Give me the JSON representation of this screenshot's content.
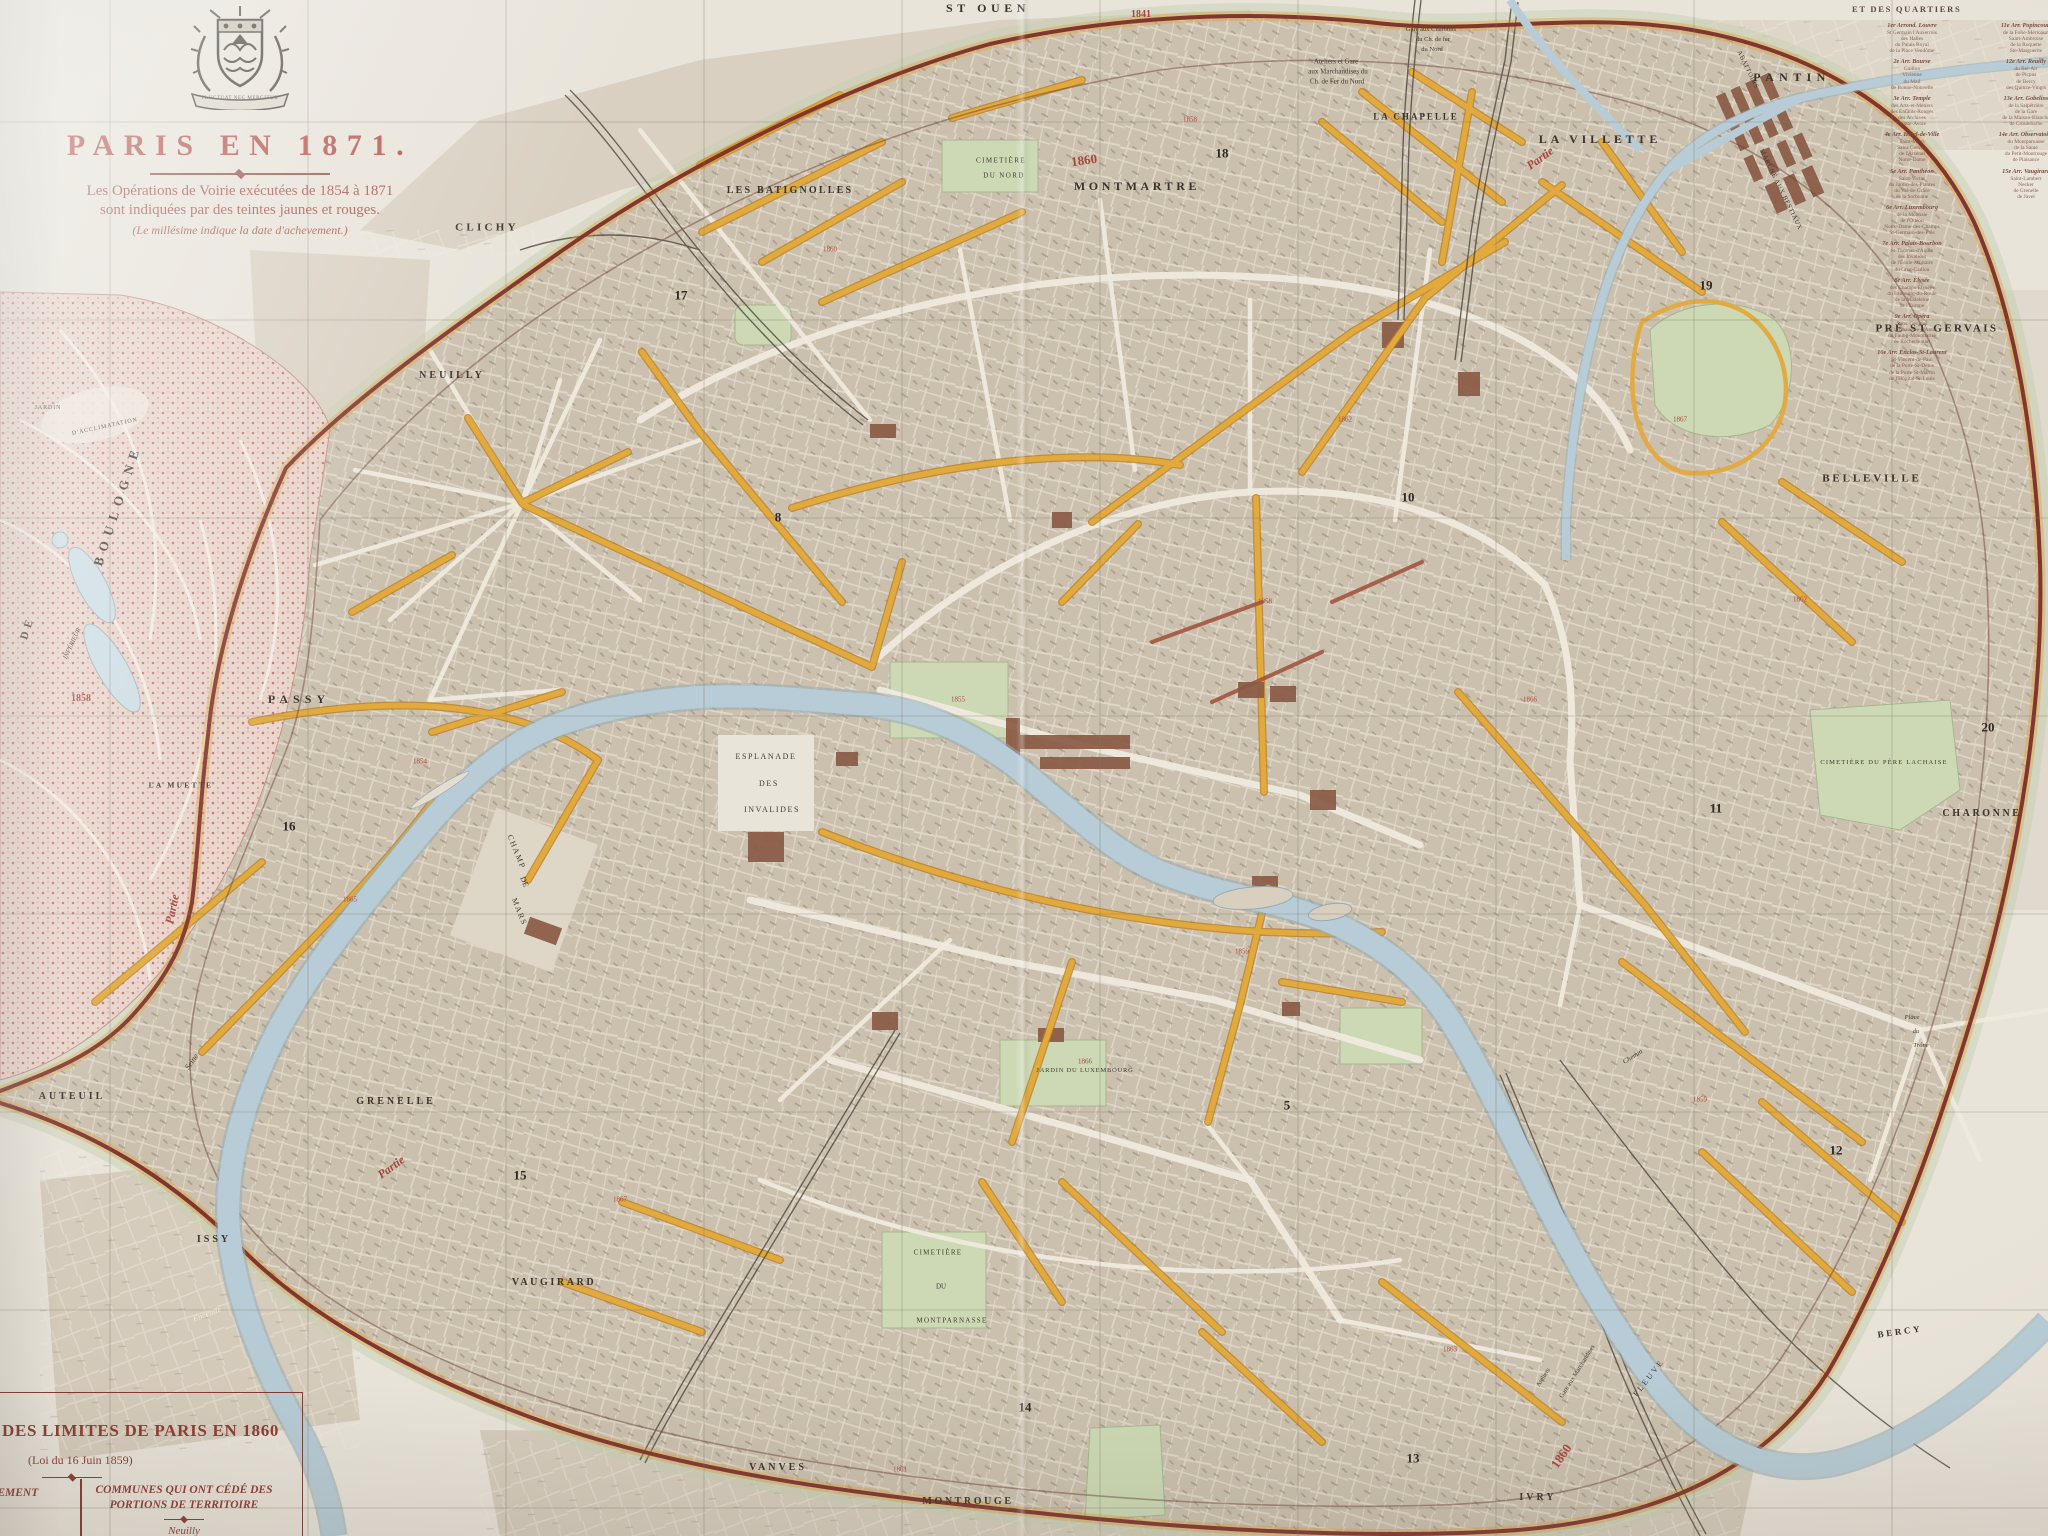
{
  "colors": {
    "paper": "#e9e4da",
    "city": "#cbc0ae",
    "suburb": "#d8cfc0",
    "water": "#b7ccd6",
    "park": "#ccd9b4",
    "bois_dot": "#ad5348",
    "wall_red": "#7c2f28",
    "ops_yellow": "#e2a93c",
    "title_red": "#b5544a",
    "legend_brown": "#7c4a3e",
    "text_black": "#38322a"
  },
  "title": {
    "main": "PARIS EN 1871.",
    "sub1": "Les Opérations de Voirie exécutées de 1854 à 1871",
    "sub2": "sont indiquées par des teintes jaunes et rouges.",
    "sub3": "(Le millésime indique la date d'achevement.)",
    "motto": "FLUCTUAT NEC MERGITUR"
  },
  "legend_quartiers": {
    "header": "ET DES QUARTIERS",
    "col1": [
      {
        "h": "1er Arrond. Louvre",
        "items": [
          "St Germain l'Auxerrois",
          "des Halles",
          "du Palais Royal",
          "de la Place Vendôme"
        ]
      },
      {
        "h": "2e Arr. Bourse",
        "items": [
          "Gaillon",
          "Vivienne",
          "du Mail",
          "de Bonne-Nouvelle"
        ]
      },
      {
        "h": "3e Arr. Temple",
        "items": [
          "des Arts-et-Métiers",
          "des Enfants-Rouges",
          "des Archives",
          "Sainte-Avoie"
        ]
      },
      {
        "h": "4e Arr. Hôtel-de-Ville",
        "items": [
          "Saint-Merri",
          "Saint-Gervais",
          "de l'Arsenal",
          "Notre-Dame"
        ]
      },
      {
        "h": "5e Arr. Panthéon",
        "items": [
          "Saint-Victor",
          "du Jardin-des-Plantes",
          "du Val-de-Grâce",
          "de la Sorbonne"
        ]
      },
      {
        "h": "6e Arr. Luxembourg",
        "items": [
          "de la Monnaie",
          "de l'Odéon",
          "Notre-Dame-des-Champs",
          "St-Germain-des-Prés"
        ]
      },
      {
        "h": "7e Arr. Palais-Bourbon",
        "items": [
          "St-Thomas-d'Aquin",
          "des Invalides",
          "de l'École-Militaire",
          "du Gros-Caillou"
        ]
      },
      {
        "h": "8e Arr. Élysée",
        "items": [
          "des Champs-Élysées",
          "du Faubourg-du-Roule",
          "de la Madeleine",
          "de l'Europe"
        ]
      },
      {
        "h": "9e Arr. Opéra",
        "items": [
          "Saint-Georges",
          "de la Chaussée-d'Antin",
          "du Faubg-Montmartre",
          "de Rochechouart"
        ]
      },
      {
        "h": "10e Arr. Enclos-St-Laurent",
        "items": [
          "St-Vincent-de-Paul",
          "de la Porte-St-Denis",
          "de la Porte-St-Martin",
          "de l'Hôpital-St-Louis"
        ]
      }
    ],
    "col2": [
      {
        "h": "11e Arr. Popincourt",
        "items": [
          "de la Folie-Méricourt",
          "Saint-Ambroise",
          "de la Roquette",
          "Ste-Marguerite"
        ]
      },
      {
        "h": "12e Arr. Reuilly",
        "items": [
          "du Bel-Air",
          "de Picpus",
          "de Bercy",
          "des Quinze-Vingts"
        ]
      },
      {
        "h": "13e Arr. Gobelins",
        "items": [
          "de la Salpêtrière",
          "de la Gare",
          "de la Maison-Blanche",
          "de Croulebarbe"
        ]
      },
      {
        "h": "14e Arr. Observatoire",
        "items": [
          "du Montparnasse",
          "de la Santé",
          "du Petit-Montrouge",
          "de Plaisance"
        ]
      },
      {
        "h": "15e Arr. Vaugirard",
        "items": [
          "Saint-Lambert",
          "Necker",
          "de Grenelle",
          "de Javel"
        ]
      }
    ]
  },
  "legend_limits": {
    "title": "DES LIMITES DE PARIS EN 1860",
    "law": "(Loi du 16 Juin 1859)",
    "col1_line1": "ÈREMENT",
    "col1_line2": "S",
    "col2_line1": "COMMUNES QUI ONT CÉDÉ DES",
    "col2_line2": "PORTIONS DE TERRITOIRE",
    "commune": "Neuilly"
  },
  "map_labels": [
    {
      "t": "ST OUEN",
      "x": 988,
      "y": 8,
      "s": 12,
      "k": "place",
      "ls": 0.38
    },
    {
      "t": "CLICHY",
      "x": 487,
      "y": 228,
      "s": 11,
      "k": "place",
      "ls": 0.3
    },
    {
      "t": "LES BATIGNOLLES",
      "x": 790,
      "y": 191,
      "s": 10,
      "k": "place",
      "ls": 0.22
    },
    {
      "t": "MONTMARTRE",
      "x": 1137,
      "y": 186,
      "s": 12,
      "k": "place",
      "ls": 0.3
    },
    {
      "t": "LA CHAPELLE",
      "x": 1416,
      "y": 117,
      "s": 9,
      "k": "place",
      "ls": 0.22
    },
    {
      "t": "LA VILLETTE",
      "x": 1600,
      "y": 139,
      "s": 12,
      "k": "place",
      "ls": 0.32
    },
    {
      "t": "PANTIN",
      "x": 1792,
      "y": 77,
      "s": 12,
      "k": "place",
      "ls": 0.45
    },
    {
      "t": "PRÉ ST GERVAIS",
      "x": 1937,
      "y": 329,
      "s": 11,
      "k": "place",
      "ls": 0.22
    },
    {
      "t": "BELLEVILLE",
      "x": 1872,
      "y": 479,
      "s": 11,
      "k": "place",
      "ls": 0.26
    },
    {
      "t": "CHARONNE",
      "x": 1982,
      "y": 814,
      "s": 10,
      "k": "place",
      "ls": 0.26
    },
    {
      "t": "NEUILLY",
      "x": 452,
      "y": 376,
      "s": 10,
      "k": "place",
      "ls": 0.3
    },
    {
      "t": "PASSY",
      "x": 299,
      "y": 699,
      "s": 12,
      "k": "place",
      "ls": 0.42
    },
    {
      "t": "LA MUETTE",
      "x": 181,
      "y": 785,
      "s": 7.5,
      "k": "place",
      "ls": 0.3
    },
    {
      "t": "AUTEUIL",
      "x": 72,
      "y": 1097,
      "s": 10,
      "k": "place",
      "ls": 0.3
    },
    {
      "t": "GRENELLE",
      "x": 396,
      "y": 1102,
      "s": 10,
      "k": "place",
      "ls": 0.3
    },
    {
      "t": "ISSY",
      "x": 214,
      "y": 1240,
      "s": 10,
      "k": "place",
      "ls": 0.3
    },
    {
      "t": "VAUGIRARD",
      "x": 554,
      "y": 1283,
      "s": 10,
      "k": "place",
      "ls": 0.26
    },
    {
      "t": "VANVES",
      "x": 778,
      "y": 1468,
      "s": 10,
      "k": "place",
      "ls": 0.3
    },
    {
      "t": "MONTROUGE",
      "x": 968,
      "y": 1502,
      "s": 10,
      "k": "place",
      "ls": 0.26
    },
    {
      "t": "IVRY",
      "x": 1538,
      "y": 1498,
      "s": 10,
      "k": "place",
      "ls": 0.3
    },
    {
      "t": "BERCY",
      "x": 1900,
      "y": 1332,
      "s": 9,
      "k": "place",
      "r": -8,
      "ls": 0.3
    },
    {
      "t": "BOULOGNE",
      "x": 117,
      "y": 505,
      "s": 13,
      "k": "place",
      "r": -72,
      "ls": 0.5
    },
    {
      "t": "DE",
      "x": 28,
      "y": 628,
      "s": 11,
      "k": "place",
      "r": -72,
      "ls": 0.4
    },
    {
      "t": "JARDIN",
      "x": 48,
      "y": 408,
      "s": 6,
      "k": "tiny",
      "ls": 0.15
    },
    {
      "t": "D'ACCLIMATATION",
      "x": 105,
      "y": 427,
      "s": 6,
      "k": "tiny",
      "r": -12,
      "ls": 0.15
    },
    {
      "t": "INFÉRIEUR",
      "x": 73,
      "y": 644,
      "s": 6.5,
      "k": "tiny-it",
      "r": -65
    },
    {
      "t": "17",
      "x": 681,
      "y": 295,
      "s": 13,
      "k": "num"
    },
    {
      "t": "18",
      "x": 1222,
      "y": 153,
      "s": 13,
      "k": "num"
    },
    {
      "t": "19",
      "x": 1706,
      "y": 285,
      "s": 13,
      "k": "num"
    },
    {
      "t": "10",
      "x": 1408,
      "y": 497,
      "s": 13,
      "k": "num"
    },
    {
      "t": "8",
      "x": 778,
      "y": 517,
      "s": 13,
      "k": "num"
    },
    {
      "t": "16",
      "x": 289,
      "y": 826,
      "s": 13,
      "k": "num"
    },
    {
      "t": "11",
      "x": 1716,
      "y": 808,
      "s": 13,
      "k": "num"
    },
    {
      "t": "20",
      "x": 1988,
      "y": 727,
      "s": 13,
      "k": "num"
    },
    {
      "t": "15",
      "x": 520,
      "y": 1175,
      "s": 13,
      "k": "num"
    },
    {
      "t": "5",
      "x": 1287,
      "y": 1105,
      "s": 13,
      "k": "num"
    },
    {
      "t": "12",
      "x": 1836,
      "y": 1150,
      "s": 13,
      "k": "num"
    },
    {
      "t": "14",
      "x": 1025,
      "y": 1407,
      "s": 13,
      "k": "num"
    },
    {
      "t": "13",
      "x": 1413,
      "y": 1458,
      "s": 13,
      "k": "num"
    },
    {
      "t": "CIMETIÈRE",
      "x": 1001,
      "y": 161,
      "s": 7,
      "k": "tiny",
      "ls": 0.2
    },
    {
      "t": "DU NORD",
      "x": 1004,
      "y": 176,
      "s": 7,
      "k": "tiny",
      "ls": 0.2
    },
    {
      "t": "CIMETIÈRE DU PÈRE LACHAISE",
      "x": 1884,
      "y": 763,
      "s": 6.5,
      "k": "tiny",
      "ls": 0.18
    },
    {
      "t": "CIMETIÈRE",
      "x": 938,
      "y": 1253,
      "s": 7,
      "k": "tiny",
      "ls": 0.18
    },
    {
      "t": "DU",
      "x": 941,
      "y": 1287,
      "s": 7,
      "k": "tiny"
    },
    {
      "t": "MONTPARNASSE",
      "x": 952,
      "y": 1321,
      "s": 7,
      "k": "tiny",
      "ls": 0.18
    },
    {
      "t": "ESPLANADE",
      "x": 766,
      "y": 757,
      "s": 8,
      "k": "tiny",
      "ls": 0.2
    },
    {
      "t": "DES",
      "x": 769,
      "y": 784,
      "s": 8,
      "k": "tiny",
      "ls": 0.2
    },
    {
      "t": "INVALIDES",
      "x": 772,
      "y": 810,
      "s": 8,
      "k": "tiny",
      "ls": 0.2
    },
    {
      "t": "CHAMP",
      "x": 516,
      "y": 852,
      "s": 8,
      "k": "tiny",
      "r": 68,
      "ls": 0.2
    },
    {
      "t": "DE",
      "x": 524,
      "y": 882,
      "s": 8,
      "k": "tiny",
      "r": 68
    },
    {
      "t": "MARS",
      "x": 519,
      "y": 912,
      "s": 8,
      "k": "tiny",
      "r": 68,
      "ls": 0.2
    },
    {
      "t": "JARDIN DU LUXEMBOURG",
      "x": 1085,
      "y": 1071,
      "s": 6.5,
      "k": "tiny",
      "ls": 0.12
    },
    {
      "t": "MARCHÉ AUX BESTIAUX",
      "x": 1780,
      "y": 190,
      "s": 6.5,
      "k": "tiny",
      "r": 64,
      "ls": 0.1
    },
    {
      "t": "ABATTOIRS",
      "x": 1747,
      "y": 70,
      "s": 6.5,
      "k": "tiny",
      "r": 64,
      "ls": 0.1
    },
    {
      "t": "Ateliers et Gare",
      "x": 1336,
      "y": 62,
      "s": 7,
      "k": "tiny"
    },
    {
      "t": "aux Marchandises du",
      "x": 1338,
      "y": 72,
      "s": 7,
      "k": "tiny"
    },
    {
      "t": "Ch. de Fer du Nord",
      "x": 1337,
      "y": 82,
      "s": 7,
      "k": "tiny"
    },
    {
      "t": "Gare aux Charbons",
      "x": 1431,
      "y": 30,
      "s": 6.5,
      "k": "tiny"
    },
    {
      "t": "du Ch. de fer",
      "x": 1433,
      "y": 40,
      "s": 6.5,
      "k": "tiny"
    },
    {
      "t": "du Nord",
      "x": 1432,
      "y": 50,
      "s": 6.5,
      "k": "tiny"
    },
    {
      "t": "Gare aux Marchandises",
      "x": 1578,
      "y": 1372,
      "s": 6.5,
      "k": "tiny",
      "r": -58
    },
    {
      "t": "Ateliers",
      "x": 1544,
      "y": 1378,
      "s": 6.5,
      "k": "tiny",
      "r": -58
    },
    {
      "t": "Place",
      "x": 1912,
      "y": 1018,
      "s": 6.5,
      "k": "tiny-it"
    },
    {
      "t": "du",
      "x": 1916,
      "y": 1032,
      "s": 6.5,
      "k": "tiny-it"
    },
    {
      "t": "Trône",
      "x": 1921,
      "y": 1046,
      "s": 6.5,
      "k": "tiny-it"
    },
    {
      "t": "Chemin",
      "x": 1633,
      "y": 1057,
      "s": 7,
      "k": "tiny-it",
      "r": -32
    },
    {
      "t": "Seine",
      "x": 192,
      "y": 1062,
      "s": 8,
      "k": "tiny-it",
      "r": -55
    },
    {
      "t": "FLEUVE",
      "x": 1649,
      "y": 1378,
      "s": 8,
      "k": "tiny",
      "r": -52,
      "ls": 0.3
    },
    {
      "t": "Partie",
      "x": 1540,
      "y": 158,
      "s": 12,
      "k": "red-it",
      "r": -36
    },
    {
      "t": "Partie",
      "x": 172,
      "y": 909,
      "s": 12,
      "k": "red-it",
      "r": -78
    },
    {
      "t": "Partie",
      "x": 391,
      "y": 1167,
      "s": 12,
      "k": "red-it",
      "r": -36
    },
    {
      "t": "1860",
      "x": 1084,
      "y": 160,
      "s": 13,
      "k": "red",
      "r": -8
    },
    {
      "t": "1841",
      "x": 1141,
      "y": 15,
      "s": 10,
      "k": "red"
    },
    {
      "t": "1858",
      "x": 81,
      "y": 699,
      "s": 10,
      "k": "red"
    },
    {
      "t": "1860",
      "x": 1561,
      "y": 1456,
      "s": 13,
      "k": "red",
      "r": -55
    },
    {
      "t": "Enceinte",
      "x": 207,
      "y": 1314,
      "s": 8.5,
      "k": "white-it",
      "r": -20
    },
    {
      "t": "1858",
      "x": 1190,
      "y": 120,
      "s": 7,
      "k": "yr"
    },
    {
      "t": "1860",
      "x": 830,
      "y": 250,
      "s": 7,
      "k": "yr"
    },
    {
      "t": "1858",
      "x": 1265,
      "y": 602,
      "s": 7,
      "k": "yr"
    },
    {
      "t": "1859",
      "x": 1242,
      "y": 952,
      "s": 7,
      "k": "yr"
    },
    {
      "t": "1866",
      "x": 1085,
      "y": 1062,
      "s": 7,
      "k": "yr"
    },
    {
      "t": "1862",
      "x": 1345,
      "y": 420,
      "s": 7,
      "k": "yr"
    },
    {
      "t": "1867",
      "x": 1680,
      "y": 420,
      "s": 7,
      "k": "yr"
    },
    {
      "t": "1862",
      "x": 1800,
      "y": 600,
      "s": 7,
      "k": "yr"
    },
    {
      "t": "1854",
      "x": 420,
      "y": 762,
      "s": 7,
      "k": "yr"
    },
    {
      "t": "1865",
      "x": 350,
      "y": 900,
      "s": 7,
      "k": "yr"
    },
    {
      "t": "1859",
      "x": 1700,
      "y": 1100,
      "s": 7,
      "k": "yr"
    },
    {
      "t": "1863",
      "x": 1450,
      "y": 1350,
      "s": 7,
      "k": "yr"
    },
    {
      "t": "1861",
      "x": 900,
      "y": 1470,
      "s": 7,
      "k": "yr"
    },
    {
      "t": "1867",
      "x": 620,
      "y": 1200,
      "s": 7,
      "k": "yr"
    },
    {
      "t": "1855",
      "x": 958,
      "y": 700,
      "s": 7,
      "k": "yr"
    },
    {
      "t": "1866",
      "x": 1530,
      "y": 700,
      "s": 7,
      "k": "yr"
    }
  ]
}
